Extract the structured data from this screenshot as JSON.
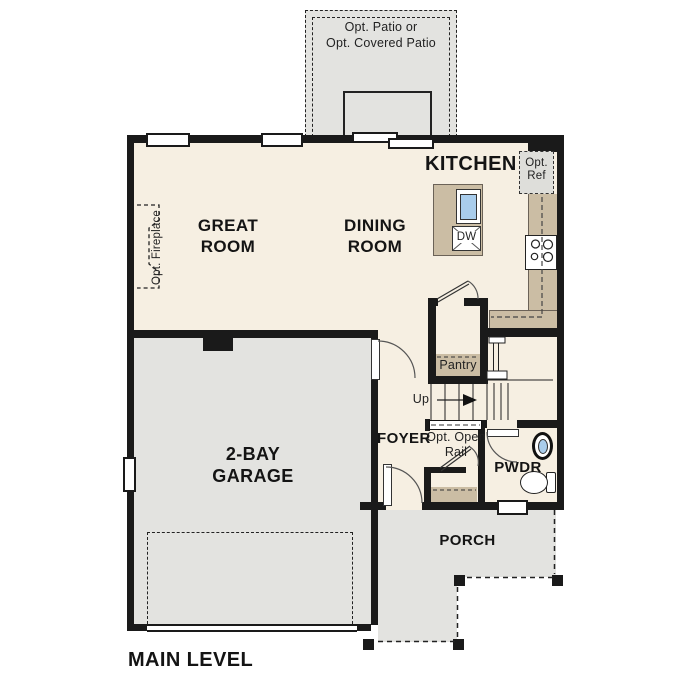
{
  "plan_title": "MAIN LEVEL",
  "rooms": {
    "great_room": [
      "GREAT",
      "ROOM"
    ],
    "dining_room": [
      "DINING",
      "ROOM"
    ],
    "kitchen": "KITCHEN",
    "garage": [
      "2-BAY",
      "GARAGE"
    ],
    "foyer": "FOYER",
    "pantry": "Pantry",
    "powder_room": "PWDR",
    "porch": "PORCH"
  },
  "options": {
    "patio": [
      "Opt. Patio or",
      "Opt. Covered Patio"
    ],
    "refrigerator": [
      "Opt.",
      "Ref"
    ],
    "fireplace": "Opt. Fireplace",
    "open_rail": [
      "Opt. Open",
      "Rail"
    ]
  },
  "stairs": {
    "up_label": "Up"
  },
  "appliances": {
    "dishwasher": "DW"
  },
  "colors": {
    "wall": "#1a1a1a",
    "floor": "#f6efe2",
    "concrete": "#e3e3e0",
    "counter": "#cbbda4",
    "water": "#a9cdec",
    "ref_fill": "#dededa"
  }
}
